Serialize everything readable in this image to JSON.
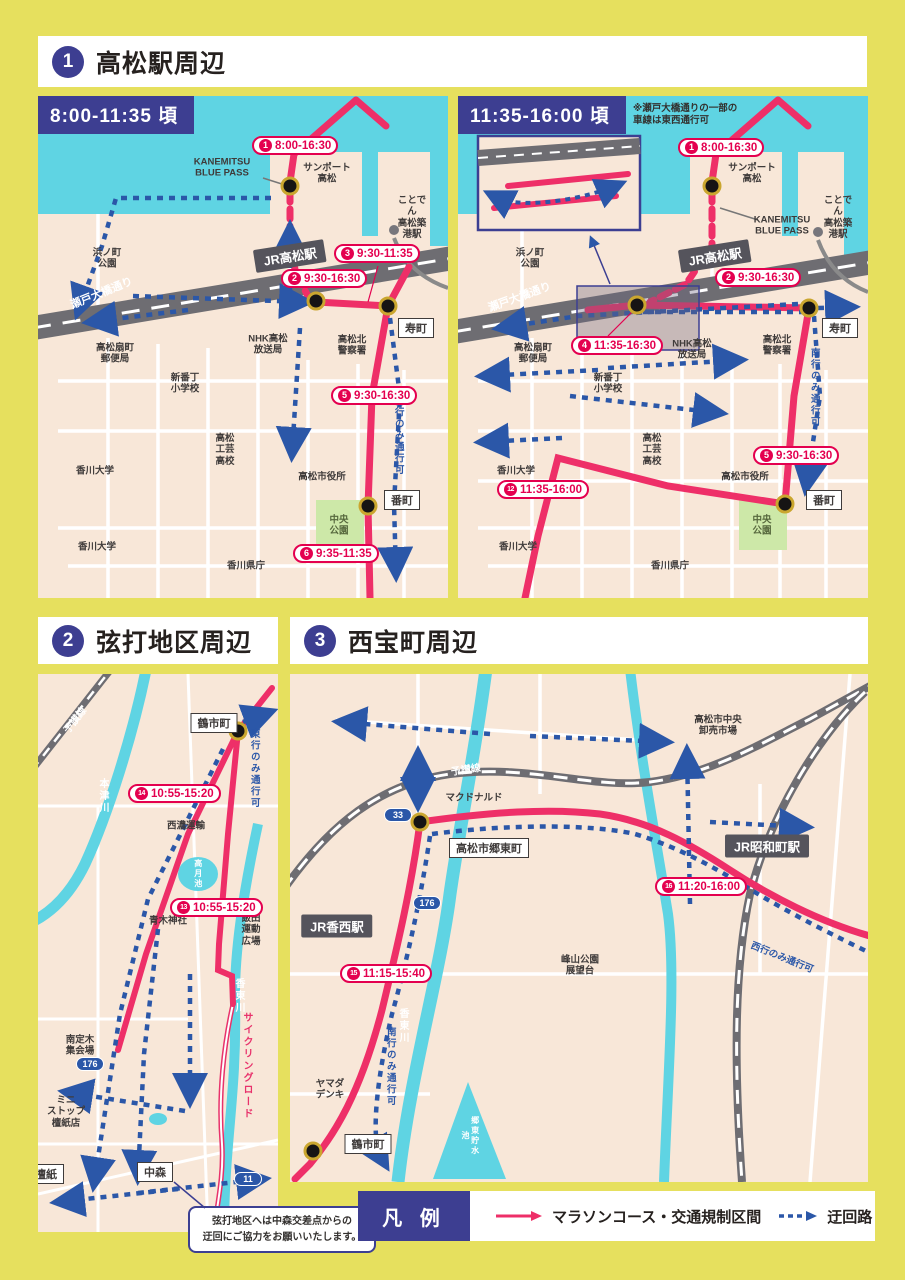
{
  "sections": {
    "s1": {
      "num": "1",
      "title": "高松駅周辺"
    },
    "s2": {
      "num": "2",
      "title": "弦打地区周辺"
    },
    "s3": {
      "num": "3",
      "title": "西宝町周辺"
    }
  },
  "legend": {
    "title": "凡 例",
    "course": "マラソンコース・交通規制区間",
    "detour": "迂回路"
  },
  "note2": "弦打地区へは中森交差点からの\n迂回にご協力をお願いいたします。",
  "map1a": {
    "badge": "8:00-11:35 頃",
    "times": [
      {
        "n": "1",
        "t": "8:00-16:30",
        "x": 214,
        "y": 40
      },
      {
        "n": "2",
        "t": "9:30-16:30",
        "x": 243,
        "y": 173
      },
      {
        "n": "3",
        "t": "9:30-11:35",
        "x": 296,
        "y": 148
      },
      {
        "n": "5",
        "t": "9:30-16:30",
        "x": 293,
        "y": 290
      },
      {
        "n": "6",
        "t": "9:35-11:35",
        "x": 255,
        "y": 448
      }
    ],
    "labels": [
      {
        "t": "KANEMITSU\nBLUE PASS",
        "x": 184,
        "y": 72
      },
      {
        "t": "サンポート\n高松",
        "x": 289,
        "y": 78
      },
      {
        "t": "ことでん\n高松築港駅",
        "x": 374,
        "y": 122
      },
      {
        "t": "浜ノ町\n公園",
        "x": 69,
        "y": 163
      },
      {
        "t": "瀬戸大橋通り",
        "x": 64,
        "y": 198,
        "r": -22,
        "c": "white",
        "s": 11
      },
      {
        "t": "高松北\n警察署",
        "x": 314,
        "y": 250
      },
      {
        "t": "NHK高松\n放送局",
        "x": 230,
        "y": 249
      },
      {
        "t": "高松扇町\n郵便局",
        "x": 77,
        "y": 258
      },
      {
        "t": "新番丁\n小学校",
        "x": 147,
        "y": 288
      },
      {
        "t": "高松\n工芸\n高校",
        "x": 187,
        "y": 354
      },
      {
        "t": "香川大学",
        "x": 57,
        "y": 375
      },
      {
        "t": "香川大学",
        "x": 59,
        "y": 451
      },
      {
        "t": "高松市役所",
        "x": 284,
        "y": 381
      },
      {
        "t": "中央\n公園",
        "x": 301,
        "y": 430,
        "c": "green"
      },
      {
        "t": "香川県庁",
        "x": 208,
        "y": 470
      },
      {
        "t": "南行のみ通行可",
        "x": 360,
        "y": 340,
        "v": 1,
        "c": "blue"
      }
    ],
    "boxes": [
      {
        "t": "寿町",
        "x": 378,
        "y": 232
      },
      {
        "t": "番町",
        "x": 364,
        "y": 404
      }
    ],
    "stations": [
      {
        "t": "JR高松駅",
        "x": 252,
        "y": 160,
        "r": -9
      }
    ],
    "shields": []
  },
  "map1b": {
    "badge": "11:35-16:00 頃",
    "note": "※瀬戸大橋通りの一部の\n車線は東西通行可",
    "times": [
      {
        "n": "1",
        "t": "8:00-16:30",
        "x": 220,
        "y": 42
      },
      {
        "n": "2",
        "t": "9:30-16:30",
        "x": 257,
        "y": 172
      },
      {
        "n": "4",
        "t": "11:35-16:30",
        "x": 113,
        "y": 240
      },
      {
        "n": "5",
        "t": "9:30-16:30",
        "x": 295,
        "y": 350
      },
      {
        "n": "12",
        "t": "11:35-16:00",
        "x": 39,
        "y": 384
      }
    ],
    "labels": [
      {
        "t": "サンポート\n高松",
        "x": 294,
        "y": 78
      },
      {
        "t": "KANEMITSU\nBLUE PASS",
        "x": 324,
        "y": 130
      },
      {
        "t": "ことでん\n高松築港駅",
        "x": 380,
        "y": 122
      },
      {
        "t": "浜ノ町\n公園",
        "x": 72,
        "y": 163
      },
      {
        "t": "瀬戸大橋通り",
        "x": 62,
        "y": 202,
        "r": -20,
        "c": "white",
        "s": 11
      },
      {
        "t": "高松北\n警察署",
        "x": 319,
        "y": 250
      },
      {
        "t": "NHK高松\n放送局",
        "x": 234,
        "y": 254
      },
      {
        "t": "高松扇町\n郵便局",
        "x": 75,
        "y": 258
      },
      {
        "t": "新番丁\n小学校",
        "x": 150,
        "y": 288
      },
      {
        "t": "高松\n工芸\n高校",
        "x": 194,
        "y": 354
      },
      {
        "t": "香川大学",
        "x": 58,
        "y": 375
      },
      {
        "t": "香川大学",
        "x": 60,
        "y": 451
      },
      {
        "t": "高松市役所",
        "x": 287,
        "y": 381
      },
      {
        "t": "中央\n公園",
        "x": 304,
        "y": 430,
        "c": "green"
      },
      {
        "t": "香川県庁",
        "x": 212,
        "y": 470
      },
      {
        "t": "南行のみ通行可",
        "x": 356,
        "y": 292,
        "v": 1,
        "c": "blue"
      }
    ],
    "boxes": [
      {
        "t": "寿町",
        "x": 382,
        "y": 232
      },
      {
        "t": "番町",
        "x": 366,
        "y": 404
      }
    ],
    "stations": [
      {
        "t": "JR高松駅",
        "x": 257,
        "y": 160,
        "r": -9
      }
    ],
    "shields": []
  },
  "map2": {
    "times": [
      {
        "n": "14",
        "t": "10:55-15:20",
        "x": 90,
        "y": 110
      },
      {
        "n": "13",
        "t": "10:55-15:20",
        "x": 132,
        "y": 224
      }
    ],
    "labels": [
      {
        "t": "予讃線",
        "x": 38,
        "y": 47,
        "r": -52,
        "c": "white",
        "s": 10
      },
      {
        "t": "本津川",
        "x": 64,
        "y": 122,
        "v": 1,
        "c": "white",
        "s": 10
      },
      {
        "t": "東行のみ通行可",
        "x": 216,
        "y": 95,
        "v": 1,
        "c": "blue"
      },
      {
        "t": "西濃運輸",
        "x": 148,
        "y": 152
      },
      {
        "t": "高月池",
        "x": 160,
        "y": 200,
        "v": 1,
        "c": "white",
        "s": 8
      },
      {
        "t": "青木神社",
        "x": 130,
        "y": 247
      },
      {
        "t": "飯田運動\n広場",
        "x": 213,
        "y": 256
      },
      {
        "t": "香東川",
        "x": 200,
        "y": 322,
        "v": 1,
        "c": "white",
        "s": 10
      },
      {
        "t": "サイクリングロード",
        "x": 208,
        "y": 392,
        "v": 1,
        "c": "red",
        "s": 10
      },
      {
        "t": "南定木\n集会場",
        "x": 42,
        "y": 372
      },
      {
        "t": "ミニ\nストップ\n檀紙店",
        "x": 28,
        "y": 438
      }
    ],
    "boxes": [
      {
        "t": "鶴市町",
        "x": 176,
        "y": 49
      },
      {
        "t": "檀紙",
        "x": 8,
        "y": 500
      },
      {
        "t": "中森",
        "x": 117,
        "y": 498
      }
    ],
    "stations": [],
    "shields": [
      {
        "t": "176",
        "x": 52,
        "y": 390
      },
      {
        "t": "11",
        "x": 210,
        "y": 505
      }
    ]
  },
  "map3": {
    "times": [
      {
        "n": "16",
        "t": "11:20-16:00",
        "x": 365,
        "y": 203
      },
      {
        "n": "15",
        "t": "11:15-15:40",
        "x": 50,
        "y": 290
      }
    ],
    "labels": [
      {
        "t": "高松市中央\n卸売市場",
        "x": 428,
        "y": 52
      },
      {
        "t": "予讃線",
        "x": 176,
        "y": 97,
        "r": -8,
        "c": "white",
        "s": 10
      },
      {
        "t": "マクドナルド",
        "x": 184,
        "y": 124
      },
      {
        "t": "峰山公園\n展望台",
        "x": 290,
        "y": 292
      },
      {
        "t": "ヤマダ\nデンキ",
        "x": 40,
        "y": 416
      },
      {
        "t": "香東川",
        "x": 112,
        "y": 352,
        "v": 1,
        "c": "white",
        "s": 10
      },
      {
        "t": "郷東貯水池",
        "x": 180,
        "y": 462,
        "v": 1,
        "c": "white",
        "s": 8
      },
      {
        "t": "西行のみ通行可",
        "x": 492,
        "y": 284,
        "r": 22,
        "c": "blue"
      },
      {
        "t": "南行のみ通行可",
        "x": 100,
        "y": 393,
        "v": 1,
        "c": "blue"
      }
    ],
    "boxes": [
      {
        "t": "高松市郷東町",
        "x": 199,
        "y": 174
      },
      {
        "t": "鶴市町",
        "x": 78,
        "y": 470
      }
    ],
    "stations": [
      {
        "t": "JR昭和町駅",
        "x": 477,
        "y": 172
      },
      {
        "t": "JR香西駅",
        "x": 47,
        "y": 252
      }
    ],
    "shields": [
      {
        "t": "33",
        "x": 108,
        "y": 141
      },
      {
        "t": "176",
        "x": 137,
        "y": 229
      }
    ]
  }
}
